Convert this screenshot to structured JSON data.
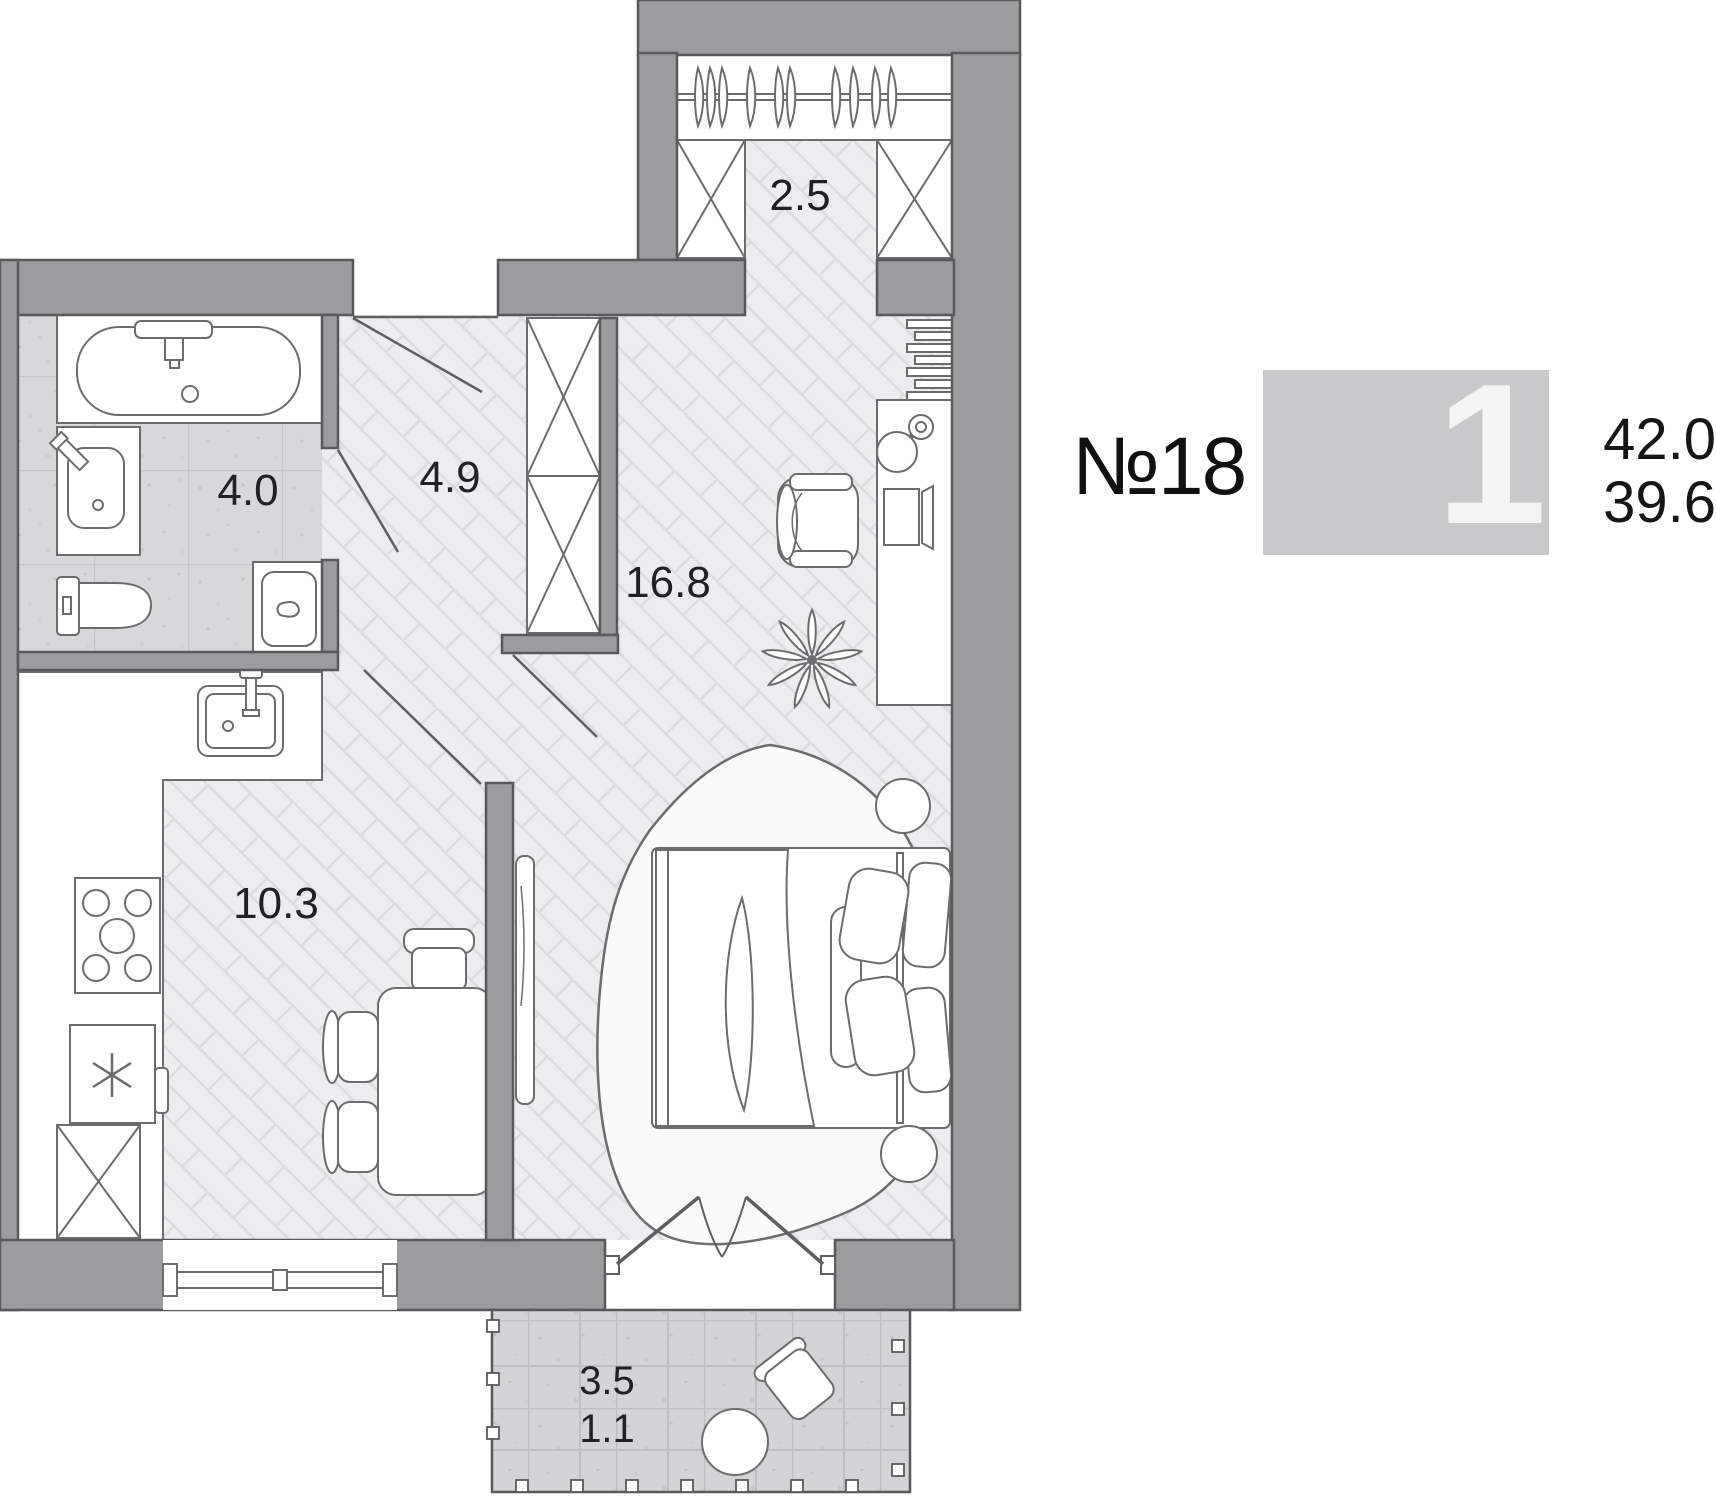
{
  "unit": {
    "number": "№18",
    "rooms": "1",
    "area_total": "42.0",
    "area_living": "39.6"
  },
  "rooms": {
    "closet": "2.5",
    "hall": "4.9",
    "bathroom": "4.0",
    "living": "16.8",
    "kitchen": "10.3",
    "balcony_full": "3.5",
    "balcony_reduced": "1.1"
  },
  "colors": {
    "wall_fill": "#9c9c9e",
    "wall_outline": "#58595b",
    "floor_wood": "#ededef",
    "floor_wood_line": "#dcdce0",
    "floor_tile": "#d8d8da",
    "tile_grid": "#c6c6c9",
    "furniture_line": "#6b6c6e",
    "badge_bg": "#c9c9cb",
    "badge_digit": "#f4f4f4",
    "label_text": "#202124"
  }
}
